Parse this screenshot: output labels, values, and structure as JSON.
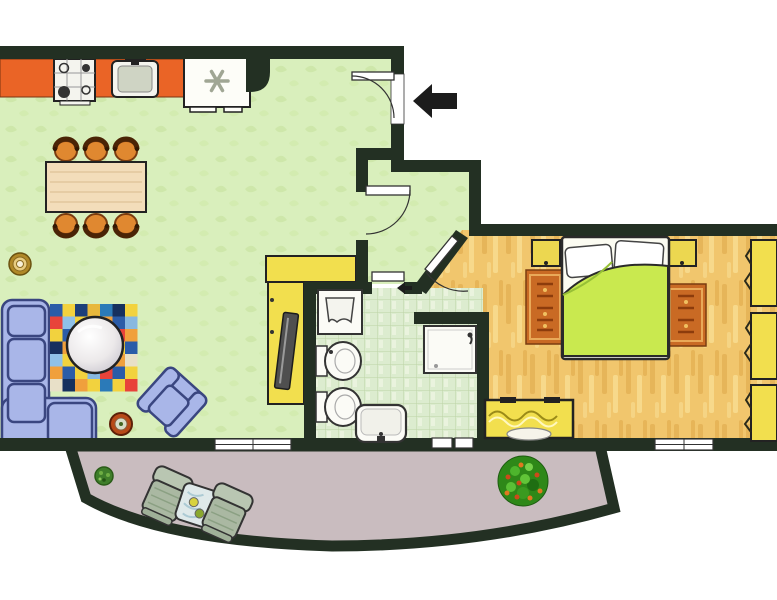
{
  "title": "Apartment floor plan",
  "colors": {
    "wall": "#233023",
    "outside": "#ffffff",
    "living_floor": "#d9efbc",
    "bathroom_floor": "#dceccf",
    "bedroom_floor": "#f1c66d",
    "terrace_floor": "#c9bcbf",
    "kitchen_counter": "#ea6426",
    "appliance_white": "#fdfdf8",
    "yellow_furniture": "#f2df4e",
    "sofa": "#a9b6e8",
    "sofa_outline": "#3a4680",
    "bed_duvet": "#c9e94f",
    "area_rug_orange": "#c96a24",
    "dining_table_wood": "#f3ddba",
    "dining_chair": "#e08830",
    "terrace_chair": "#aab8a2",
    "terrace_table": "#dfe9ea",
    "plant_green": "#3e7a2a",
    "bush_green": "#2e8818",
    "arrow_black": "#1c1c1c",
    "fixture_white": "#fbfbf6"
  },
  "rooms": [
    {
      "id": "living-room-kitchen",
      "label": "Living room with open kitchen"
    },
    {
      "id": "hallway",
      "label": "Hallway"
    },
    {
      "id": "bathroom",
      "label": "Bathroom"
    },
    {
      "id": "bedroom",
      "label": "Bedroom"
    },
    {
      "id": "terrace",
      "label": "Terrace"
    }
  ],
  "furniture": {
    "kitchen": [
      "counter",
      "stove",
      "sink",
      "refrigerator"
    ],
    "living": [
      "dining-table",
      "dining-chairs-x6",
      "corner-sofa",
      "patchwork-rug",
      "round-coffee-table",
      "armchair",
      "tv-cabinet",
      "tv",
      "plant-pot",
      "ring-pot"
    ],
    "bathroom": [
      "washbasin-unit",
      "bidet",
      "toilet",
      "shower",
      "washbasin"
    ],
    "bedroom": [
      "double-bed",
      "nightstand-x2",
      "oriental-rug-x2",
      "dresser",
      "wardrobe"
    ],
    "terrace": [
      "lounge-chair-x2",
      "side-table",
      "small-plant",
      "flowering-bush"
    ]
  },
  "entrance": {
    "arrow_direction": "left"
  },
  "rug": {
    "x": 50,
    "y": 304,
    "cols": 7,
    "rows": 7,
    "cell": 12.5,
    "cells": [
      "#2b5ca8",
      "#f2d23e",
      "#1c3f7a",
      "#e8b83c",
      "#2b7ab8",
      "#16305e",
      "#f2d23e",
      "#e8433a",
      "#8fc1e8",
      "#f2d23e",
      "#d8e8f0",
      "#f0a03c",
      "#2b5ca8",
      "#88b8e0",
      "#f2d23e",
      "#2b5ca8",
      "#e8e0c8",
      "#b8d8ee",
      "#f2d23e",
      "#e8433a",
      "#f0a03c",
      "#16305e",
      "#f0a03c",
      "#b02820",
      "#e8e0c8",
      "#2b7ab8",
      "#f2d23e",
      "#2b5ca8",
      "#8fc1e8",
      "#f2d23e",
      "#e8433a",
      "#f0c860",
      "#16305e",
      "#f0a03c",
      "#e8e0c8",
      "#f0a03c",
      "#2b5ca8",
      "#f2d23e",
      "#88b8e0",
      "#e8433a",
      "#2b5ca8",
      "#f2d23e",
      "#e8e0c8",
      "#16305e",
      "#f0a03c",
      "#f2d23e",
      "#2b7ab8",
      "#f2d23e",
      "#e8433a"
    ]
  }
}
